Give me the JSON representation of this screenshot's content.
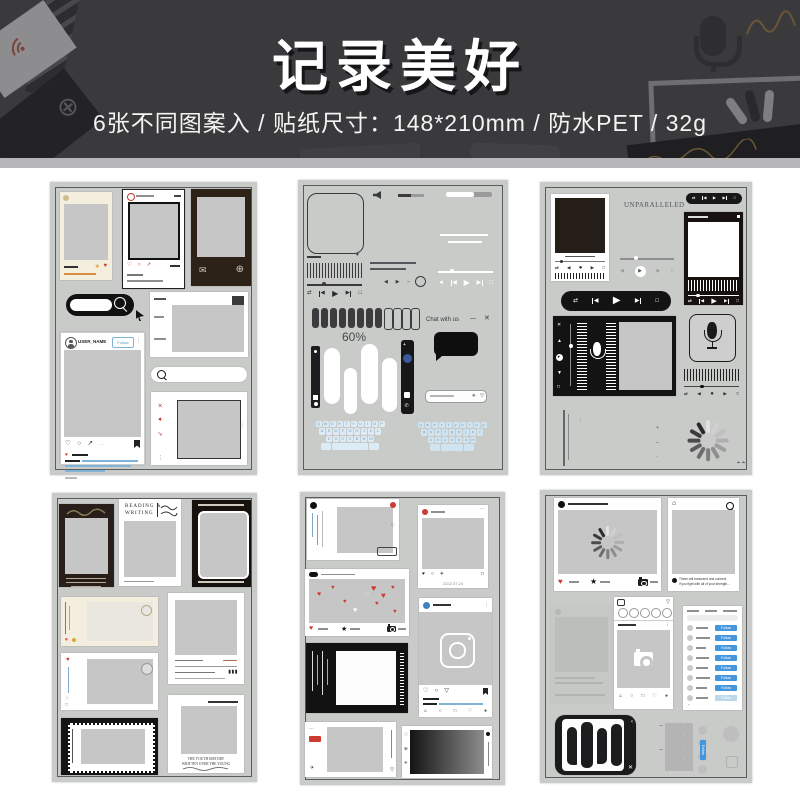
{
  "header": {
    "title": "记录美好",
    "subtitle": "6张不同图案入 / 贴纸尺寸：148*210mm / 防水PET / 32g"
  },
  "colors": {
    "header_bg": "#3a3a3c",
    "sheet_bg": "#c9cbc9",
    "accent_red": "#cf3a30",
    "link_blue": "#7fb3d8",
    "follow_blue": "#4496dd",
    "cream": "#f3eedd",
    "dark_frame": "#2b211b",
    "black": "#161616",
    "key_blue": "#dcebf5"
  },
  "icons": {
    "search": "css-magnifier",
    "heart": "♥",
    "heart_outline": "♡",
    "circle": "○",
    "share": "↗",
    "star": "★",
    "envelope": "✉",
    "globe": "⊕",
    "close": "✕",
    "minimize": "—",
    "shuffle": "⇄",
    "prev": "◀",
    "play": "▶",
    "stop": "□",
    "record": "●",
    "home": "⌂",
    "plane": "✈",
    "more_v": "⋮",
    "more_h": "⋯",
    "down": "▽",
    "caret": "⌃",
    "speaker": "◄",
    "mic": "css-mic",
    "camera": "css-camera",
    "spinner": "css-spinner",
    "instagram": "css-instagram",
    "bookmark": "css-bookmark",
    "plus": "+",
    "minus": "–",
    "up_arrow": "↑"
  },
  "sheet1": {
    "user_name": "USER_NAME",
    "follow": "Follow"
  },
  "sheet2": {
    "battery": "60%",
    "chat_title": "Chat with us",
    "kb1": [
      "QWERTYUIOP",
      "ASDFGHJKL",
      "ZXCVBNM"
    ],
    "kb2": [
      "qwertyuiop",
      "asdfghjkl",
      "zxcvbnm"
    ]
  },
  "sheet3": {
    "word": "UNPARALLELED"
  },
  "sheet4": {
    "reading": "READING &",
    "writing": "WRITING",
    "youth1": "THE YOUTH HISTORY",
    "youth2": "WRITTEN OVER THE YOUNG"
  },
  "sheet5": {
    "date": "2222.07.24"
  },
  "sheet6": {
    "follow": "Follow",
    "cap1": "These will transcend and connect",
    "cap2": "if you fight with all of your strength..."
  }
}
